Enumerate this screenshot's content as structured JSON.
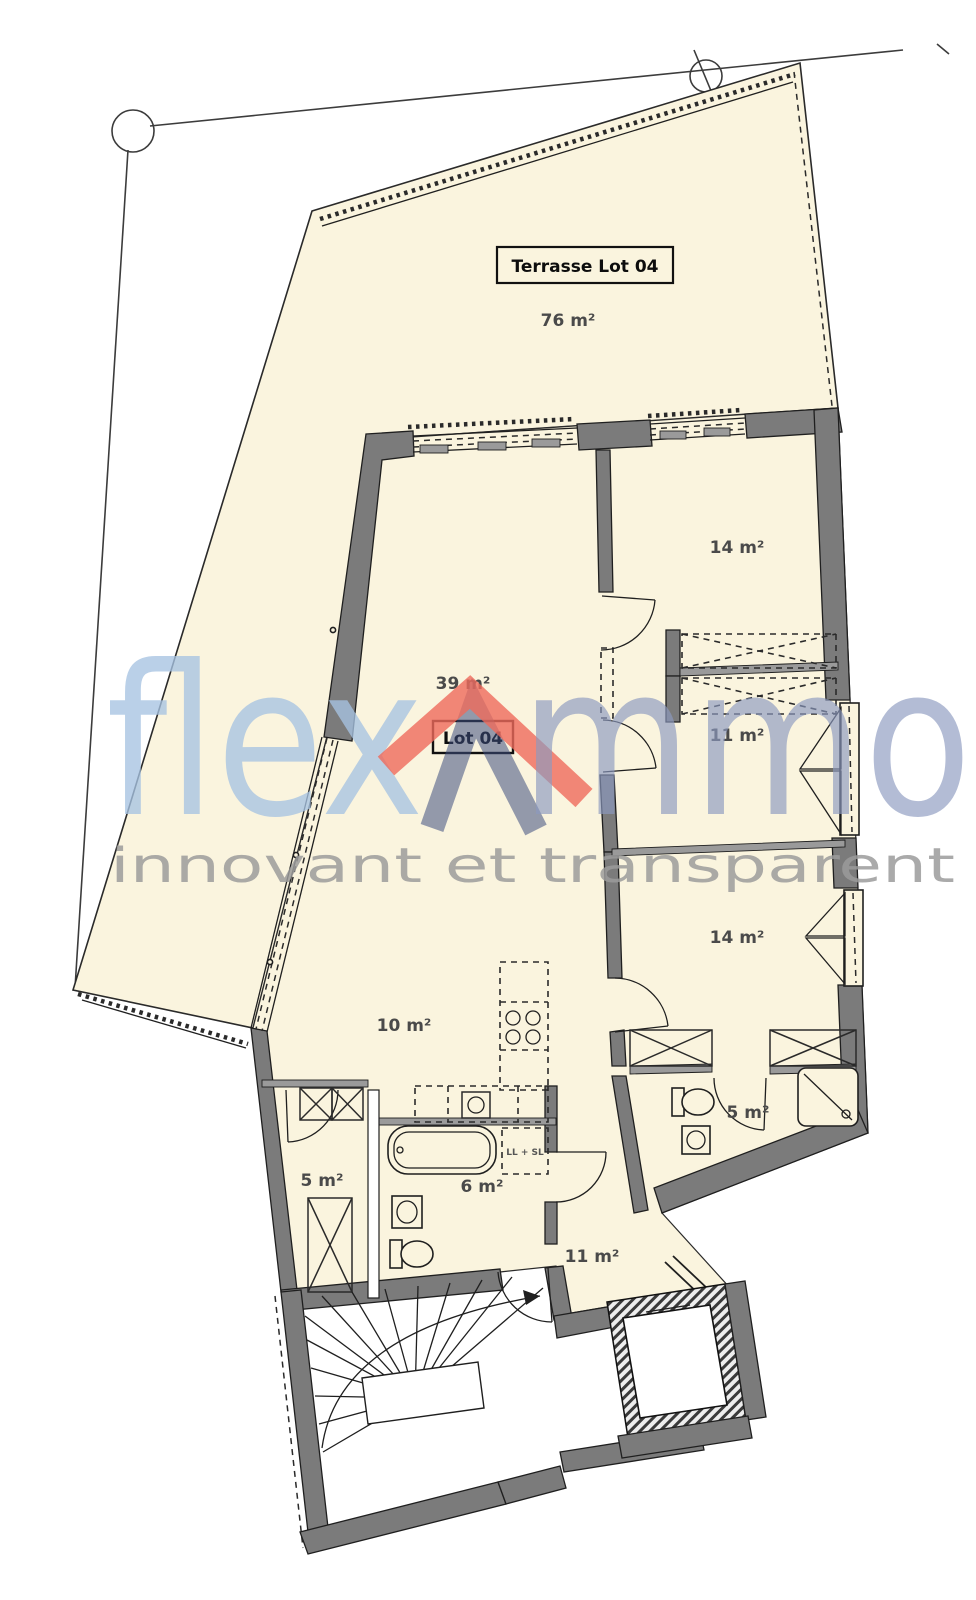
{
  "page": {
    "title": "Plan d'appartement Lot 04"
  },
  "watermark": {
    "brand_prefix": "flex",
    "brand_suffix": "mmo",
    "tagline": "innovant et transparent"
  },
  "colors": {
    "floor_cream": "#FAF4DE",
    "wall_gray": "#7B7B7B",
    "thin_wall_gray": "#9A9A9A",
    "line_dark": "#1F1F1F",
    "brand_light_blue": "#A6C3E2",
    "brand_slate_blue": "#8C9ABF",
    "brand_dark_blue": "#3E4E7F",
    "brand_red": "#EF6A5B",
    "tagline_gray": "#9B9B9B"
  },
  "rooms": {
    "terrace": {
      "title": "Terrasse Lot 04",
      "area": "76 m²"
    },
    "lot": {
      "title": "Lot 04"
    },
    "living": {
      "area": "39 m²"
    },
    "bedroom_north": {
      "area": "14 m²"
    },
    "dressing": {
      "area": "11 m²"
    },
    "bedroom_east": {
      "area": "14 m²"
    },
    "kitchen": {
      "area": "10 m²"
    },
    "bathroom_east": {
      "area": "5 m²"
    },
    "entry_west": {
      "area": "5 m²"
    },
    "bathroom_west": {
      "area": "6 m²"
    },
    "hall": {
      "area": "11 m²"
    },
    "laundry_note": "LL + SL"
  }
}
